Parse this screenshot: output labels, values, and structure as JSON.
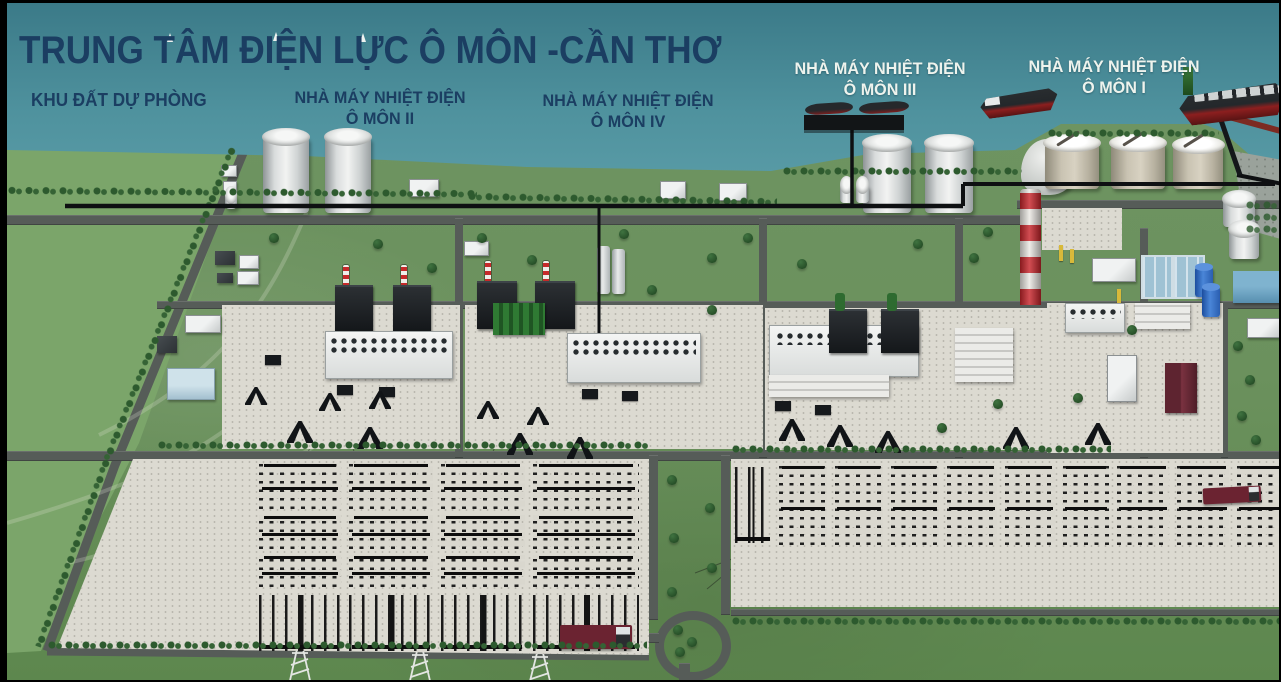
{
  "header": {
    "title": "TRUNG TÂM ĐIỆN LỰC Ô MÔN -CẦN THƠ"
  },
  "zone_labels": {
    "reserve": "KHU ĐẤT DỰ PHÒNG",
    "plants": [
      {
        "name": "NHÀ MÁY NHIỆT ĐIỆN",
        "unit": "Ô MÔN II"
      },
      {
        "name": "NHÀ MÁY NHIỆT ĐIỆN",
        "unit": "Ô MÔN IV"
      },
      {
        "name": "NHÀ MÁY NHIỆT ĐIỆN",
        "unit": "Ô MÔN III"
      },
      {
        "name": "NHÀ MÁY NHIỆT ĐIỆN",
        "unit": "Ô MÔN I"
      }
    ]
  },
  "palette": {
    "water": "#4f929e",
    "land_green": "#6b915d",
    "field_green": "#7ba56a",
    "road_gray": "#565c58",
    "concrete": "#dcdad1",
    "equipment_black": "#1d1d1d",
    "chimney_red": "#c8262c",
    "label_navy": "#1b3e62",
    "label_white": "#eef3ed",
    "tank_white": "#e9ebea",
    "tank_tan": "#cdc7b6",
    "tank_blue": "#2f6fc4",
    "pool_blue": "#9fc2d4",
    "ship_hull": "#23262a",
    "ship_keel_red": "#8c1f1f",
    "truck_maroon": "#6b2331",
    "tree_green": "#2d5a2e"
  }
}
